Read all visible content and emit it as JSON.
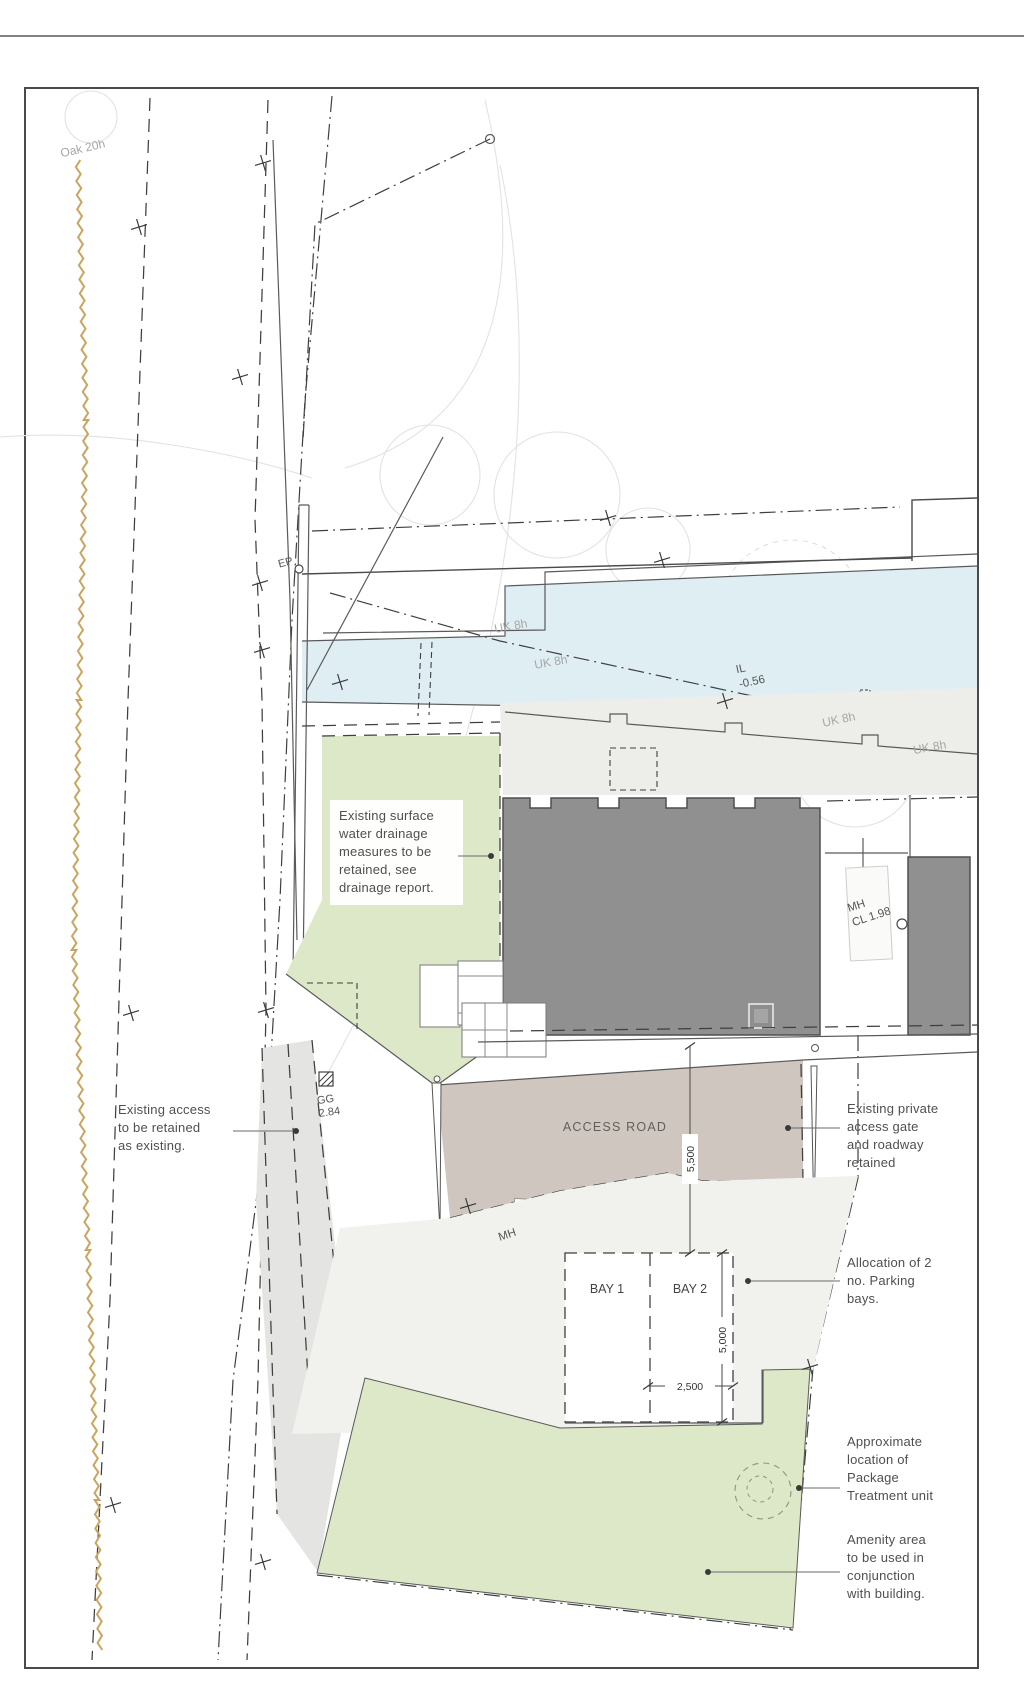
{
  "labels": {
    "oak": "Oak 20h",
    "ep": "EP",
    "uk8h_a": "UK 8h",
    "uk8h_b": "UK 8h",
    "uk8h_c": "UK 8h",
    "uk8h_d": "UK 8h",
    "il": {
      "lines": [
        "IL",
        "-0.56"
      ]
    },
    "mh_cover": {
      "lines": [
        "MH",
        "CL 1.98"
      ]
    },
    "gg": {
      "lines": [
        "GG",
        "2.84"
      ]
    },
    "access_road": "ACCESS ROAD",
    "mh_road": "MH",
    "bay_1": "BAY 1",
    "bay_2": "BAY 2"
  },
  "dimensions": {
    "building_to_bays": "5,500",
    "bay_depth": "5,000",
    "bay_width": "2,500"
  },
  "annotations": {
    "drainage": {
      "lines": [
        "Existing surface",
        "water drainage",
        "measures to be",
        "retained, see",
        "drainage report."
      ]
    },
    "existing_access": {
      "lines": [
        "Existing access",
        "to be retained",
        "as existing."
      ]
    },
    "private_gate": {
      "lines": [
        "Existing private",
        "access gate",
        "and roadway",
        "retained"
      ]
    },
    "parking": {
      "lines": [
        "Allocation of 2",
        "no. Parking",
        "bays."
      ]
    },
    "treatment_unit": {
      "lines": [
        "Approximate",
        "location of",
        "Package",
        "Treatment unit"
      ]
    },
    "amenity": {
      "lines": [
        "Amenity area",
        "to be used in",
        "conjunction",
        "with building."
      ]
    }
  },
  "colors": {
    "water": "#dfeef3",
    "grass": "#dde8c8",
    "road_surface": "#cfc7bf",
    "building_fill": "#909090",
    "apron": "#ededea",
    "drive": "#e4e4e2",
    "hedgerow": "#c9a55f",
    "annotation_text": "#4f4f4f",
    "survey_text": "#a6a6a6",
    "line_dark": "#3f3f3f"
  }
}
